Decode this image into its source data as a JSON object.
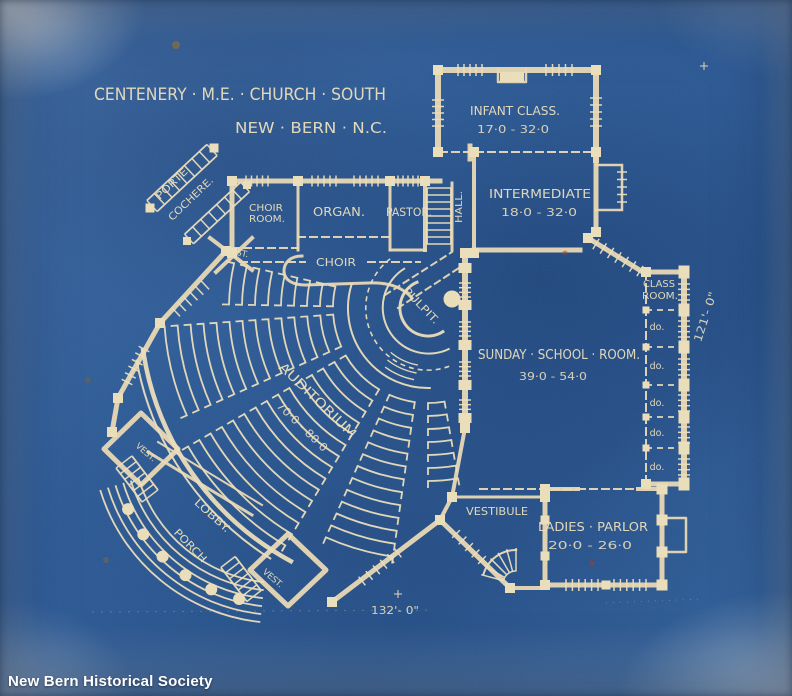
{
  "document": {
    "title_line1": "CENTENERY · M.E. · CHURCH · SOUTH",
    "title_line2": "NEW · BERN · N.C.",
    "credit": "New Bern Historical Society"
  },
  "rooms": {
    "infant_class": {
      "name": "INFANT CLASS.",
      "dims": "17·0 - 32·0"
    },
    "intermediate": {
      "name": "INTERMEDIATE",
      "dims": "18·0 - 32·0"
    },
    "hall": {
      "name": "HALL."
    },
    "choir_room": {
      "line1": "CHOIR",
      "line2": "ROOM."
    },
    "organ": {
      "name": "ORGAN."
    },
    "pastor": {
      "name": "PASTOR."
    },
    "choir": {
      "name": "CHOIR"
    },
    "pulpit": {
      "name": "PULPIT."
    },
    "auditorium": {
      "name": "AUDITORIUM",
      "dims": "70·0 - 80·0"
    },
    "sunday_school": {
      "name": "SUNDAY · SCHOOL · ROOM.",
      "dims": "39·0 - 54·0"
    },
    "class_room": {
      "line1": "CLASS",
      "line2": "ROOM.",
      "ditto": [
        "do.",
        "do.",
        "do.",
        "do.",
        "do."
      ]
    },
    "ladies_parlor": {
      "name": "LADIES · PARLOR",
      "dims": "20·0 - 26·0"
    },
    "vestibule": {
      "name": "VESTIBULE"
    },
    "porte_cochere": {
      "line1": "PORTE",
      "line2": "COCHERE."
    },
    "lobby": {
      "name": "LOBBY."
    },
    "porch": {
      "name": "PORCH"
    },
    "vest_nw": {
      "name": "VEST."
    },
    "vest_w": {
      "name": "VEST."
    },
    "vest_s": {
      "name": "VEST."
    }
  },
  "dimensions": {
    "overall_width": "132'- 0\"",
    "overall_height": "121'- 0\""
  },
  "colors": {
    "paper_blue": "#2e5c98",
    "line_cream": "#ecdfba",
    "credit_white": "#ffffff"
  }
}
